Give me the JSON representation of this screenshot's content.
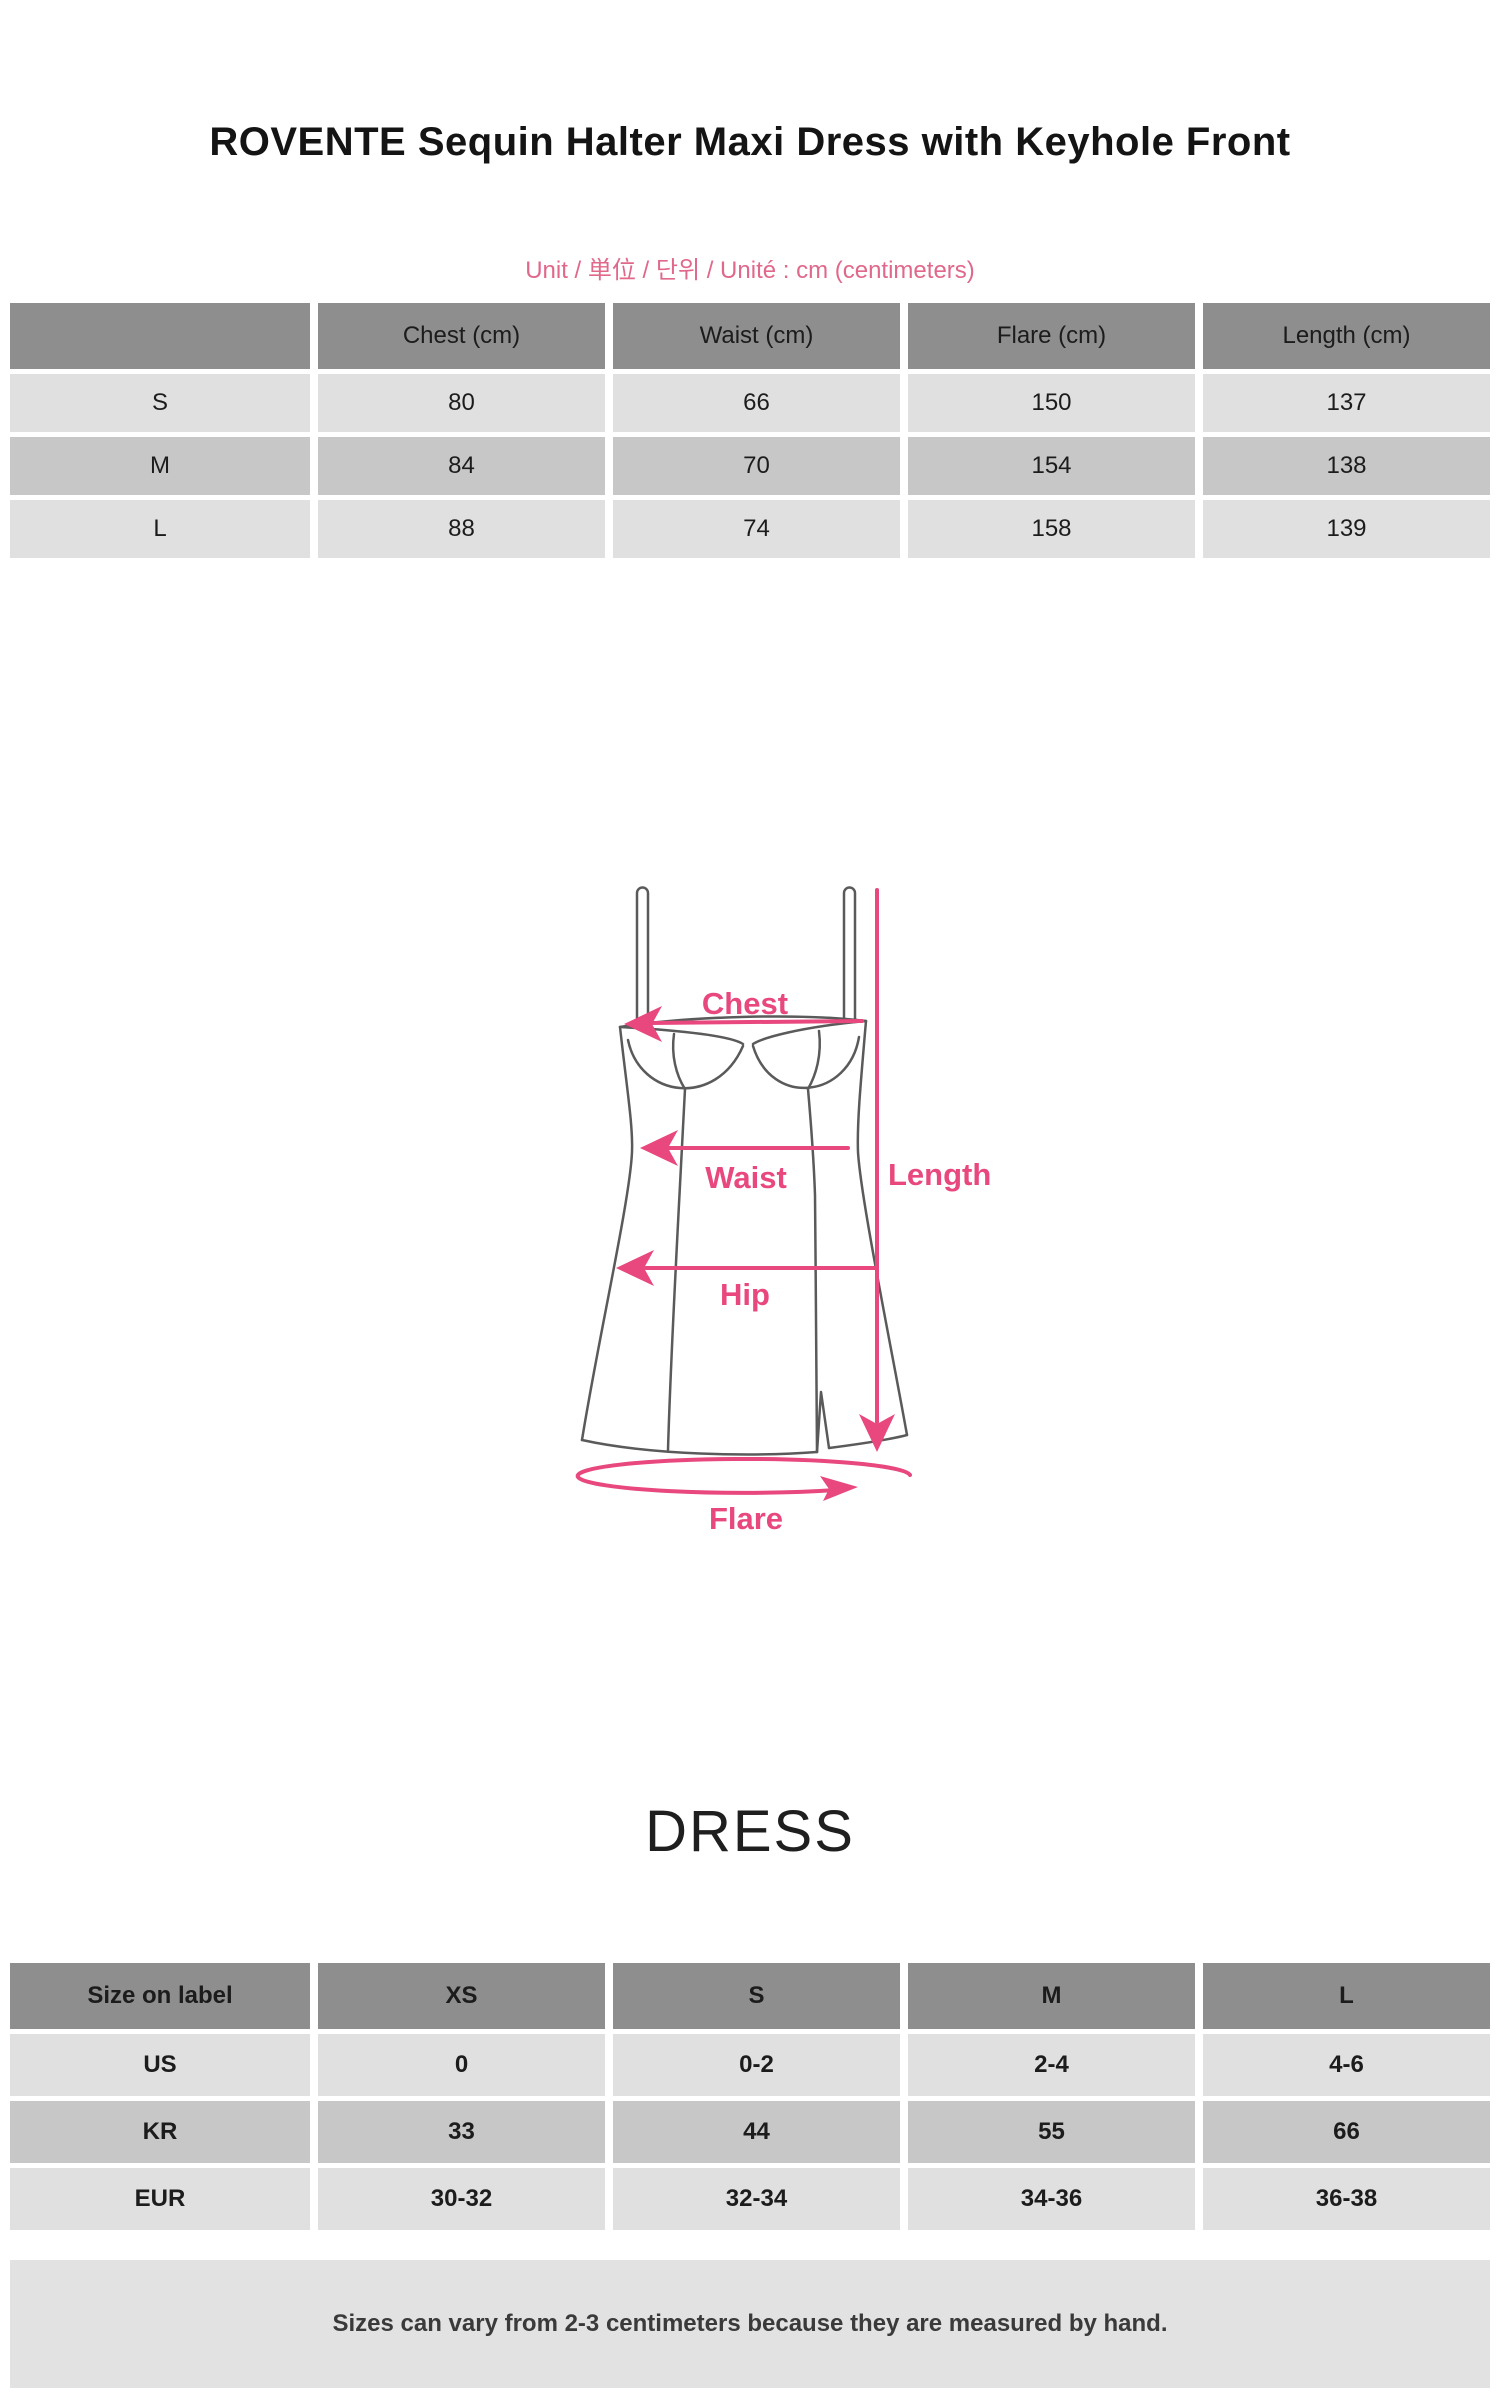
{
  "page": {
    "title": "ROVENTE Sequin Halter Maxi Dress with Keyhole Front",
    "unit_note": "Unit / 単位 / 단위 / Unité : cm (centimeters)",
    "section_heading": "DRESS",
    "footer_note": "Sizes can vary from 2-3 centimeters because they are measured by hand."
  },
  "colors": {
    "table_header_gray": "#8e8e8e",
    "row_light_gray": "#e0e0e0",
    "row_mid_gray": "#c7c7c7",
    "footer_band_gray": "#e2e2e2",
    "accent_pink": "#e8487d",
    "unit_note_pink": "#e0688a",
    "dress_line_gray": "#5a5a5a"
  },
  "measurement_table": {
    "columns": [
      "",
      "Chest (cm)",
      "Waist (cm)",
      "Flare (cm)",
      "Length (cm)"
    ],
    "rows": [
      {
        "label": "S",
        "values": [
          "80",
          "66",
          "150",
          "137"
        ]
      },
      {
        "label": "M",
        "values": [
          "84",
          "70",
          "154",
          "138"
        ]
      },
      {
        "label": "L",
        "values": [
          "88",
          "74",
          "158",
          "139"
        ]
      }
    ]
  },
  "diagram": {
    "labels": {
      "chest": "Chest",
      "waist": "Waist",
      "hip": "Hip",
      "length": "Length",
      "flare": "Flare"
    }
  },
  "size_conversion_table": {
    "columns": [
      "Size on label",
      "XS",
      "S",
      "M",
      "L"
    ],
    "rows": [
      {
        "label": "US",
        "values": [
          "0",
          "0-2",
          "2-4",
          "4-6"
        ]
      },
      {
        "label": "KR",
        "values": [
          "33",
          "44",
          "55",
          "66"
        ]
      },
      {
        "label": "EUR",
        "values": [
          "30-32",
          "32-34",
          "34-36",
          "36-38"
        ]
      }
    ]
  }
}
